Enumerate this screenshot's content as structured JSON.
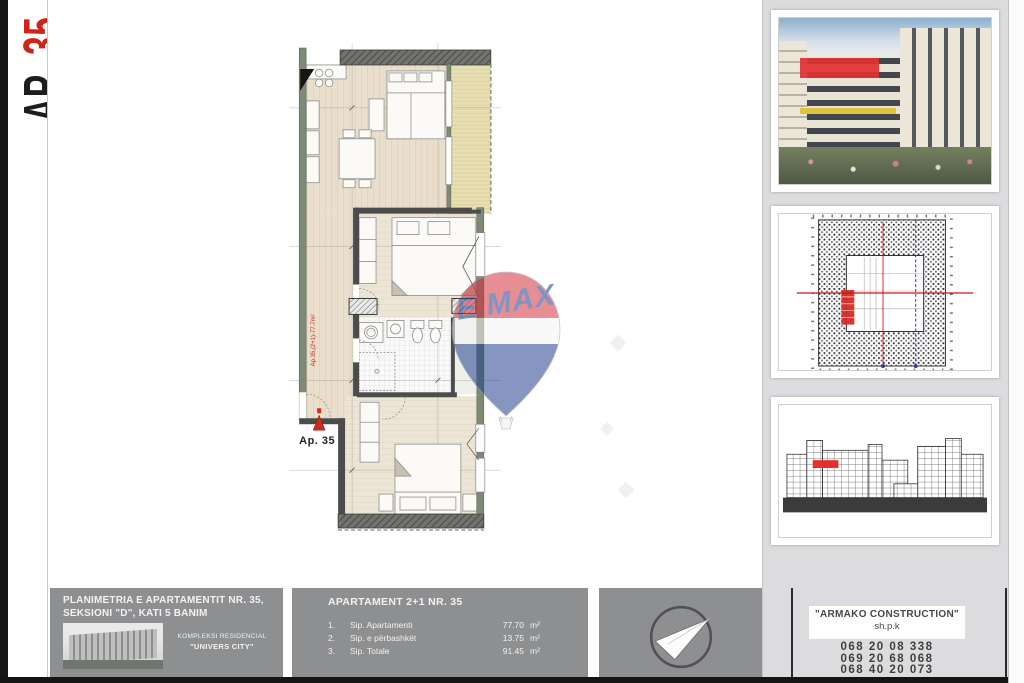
{
  "side_label": {
    "prefix": "AP_",
    "number": "35"
  },
  "plan": {
    "entry_marker_label": "Ap. 35",
    "wall_note": "Ap.35,(2+1)-77.7m²"
  },
  "watermark": {
    "e": "E",
    "slash": "/",
    "max": "MAX"
  },
  "titleblock": {
    "left": {
      "title_line1": "PLANIMETRIA E APARTAMENTIT NR. 35,",
      "title_line2": "SEKSIONI \"D\", KATI 5 BANIM",
      "complex_line1": "KOMPLEKSI RESIDENCIAL",
      "complex_line2": "\"UNIVERS CITY\""
    },
    "center": {
      "title": "APARTAMENT 2+1 NR. 35",
      "rows": [
        {
          "num": "1.",
          "label": "Sip. Apartamenti",
          "value": "77.70",
          "unit": "m²"
        },
        {
          "num": "2.",
          "label": "Sip. e përbashkët",
          "value": "13.75",
          "unit": "m²"
        },
        {
          "num": "3.",
          "label": "Sip. Totale",
          "value": "91.45",
          "unit": "m²"
        }
      ]
    },
    "right": {
      "company": "\"ARMAKO CONSTRUCTION\"",
      "legal_form": "sh.p.k",
      "phones": [
        "068 20 08 338",
        "069 20 68 068",
        "068 40 20 073"
      ]
    }
  },
  "colors": {
    "accent_red": "#e23131",
    "panel_gray": "#8e8f91",
    "sidebar_gray": "#dcdcde",
    "balloon_red": "#d2323c",
    "balloon_blue": "#24418e",
    "wall_green": "#7d8a76"
  }
}
